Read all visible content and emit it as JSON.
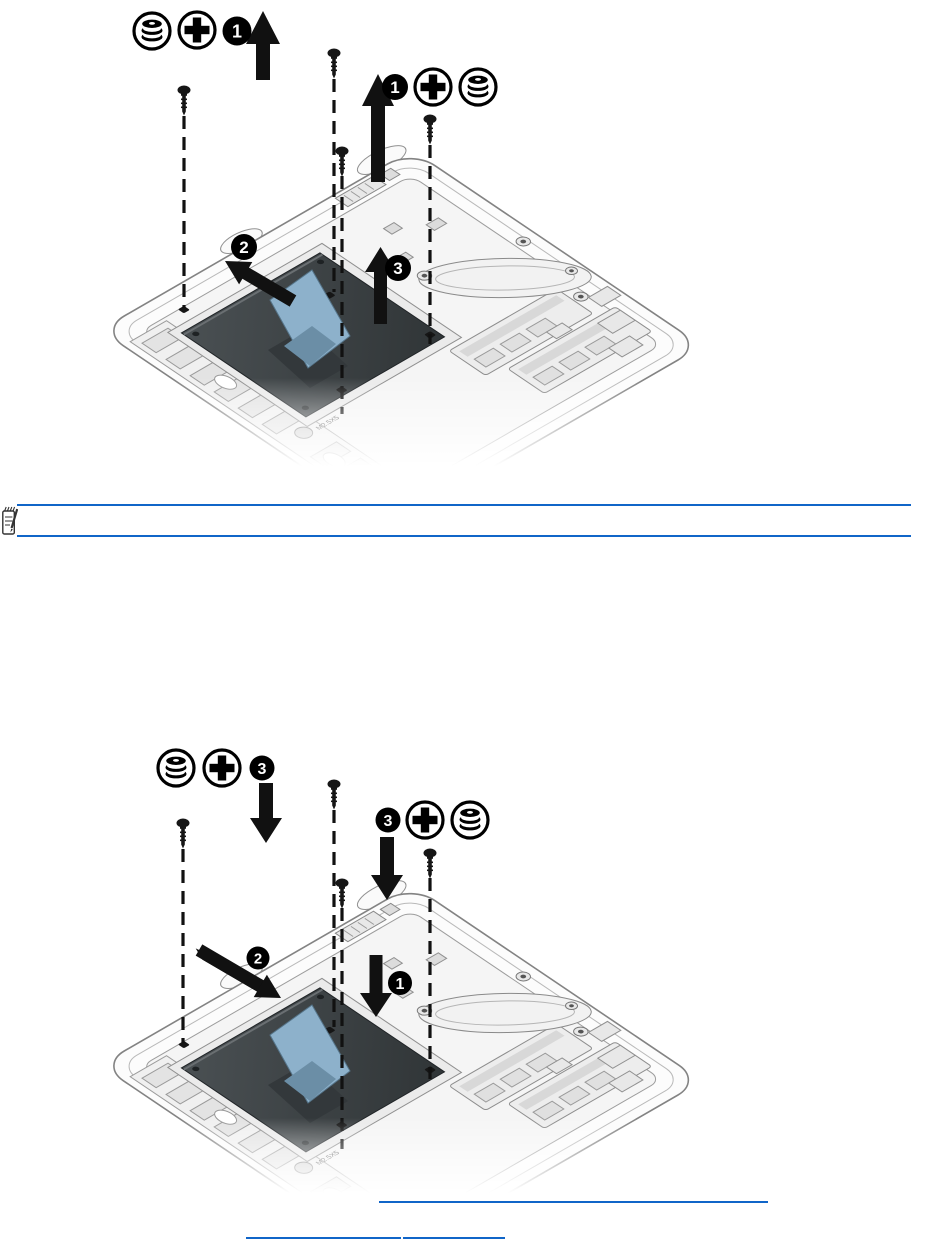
{
  "page": {
    "type": "service-manual-page",
    "background": "#ffffff"
  },
  "figures": {
    "removal": {
      "name": "hard-drive-removal-illustration",
      "legend_left_step": "1",
      "legend_right_step": "1",
      "callout_pull_tab": "2",
      "callout_lift": "3",
      "screw_label": "M2.5X5",
      "arrow_direction": "up"
    },
    "installation": {
      "name": "hard-drive-installation-illustration",
      "legend_left_step": "3",
      "legend_right_step": "3",
      "callout_seat": "1",
      "callout_slide": "2",
      "screw_label": "M2.5X5",
      "arrow_direction": "down"
    }
  },
  "icons": {
    "hdd": "hard-drive-icon",
    "phillips": "phillips-screwdriver-icon",
    "screw": "screw-icon",
    "note": "note-icon"
  },
  "note": {
    "text": ""
  },
  "links": {
    "link_1": {
      "text": ""
    },
    "link_2a": {
      "text": ""
    },
    "link_2b": {
      "text": ""
    }
  },
  "colors": {
    "rule_blue": "#1065c8",
    "tab_blue": "#8db1cb",
    "tab_fold": "#6b8ea6",
    "hdd_dark": "#3c4144",
    "ink": "#111111"
  }
}
